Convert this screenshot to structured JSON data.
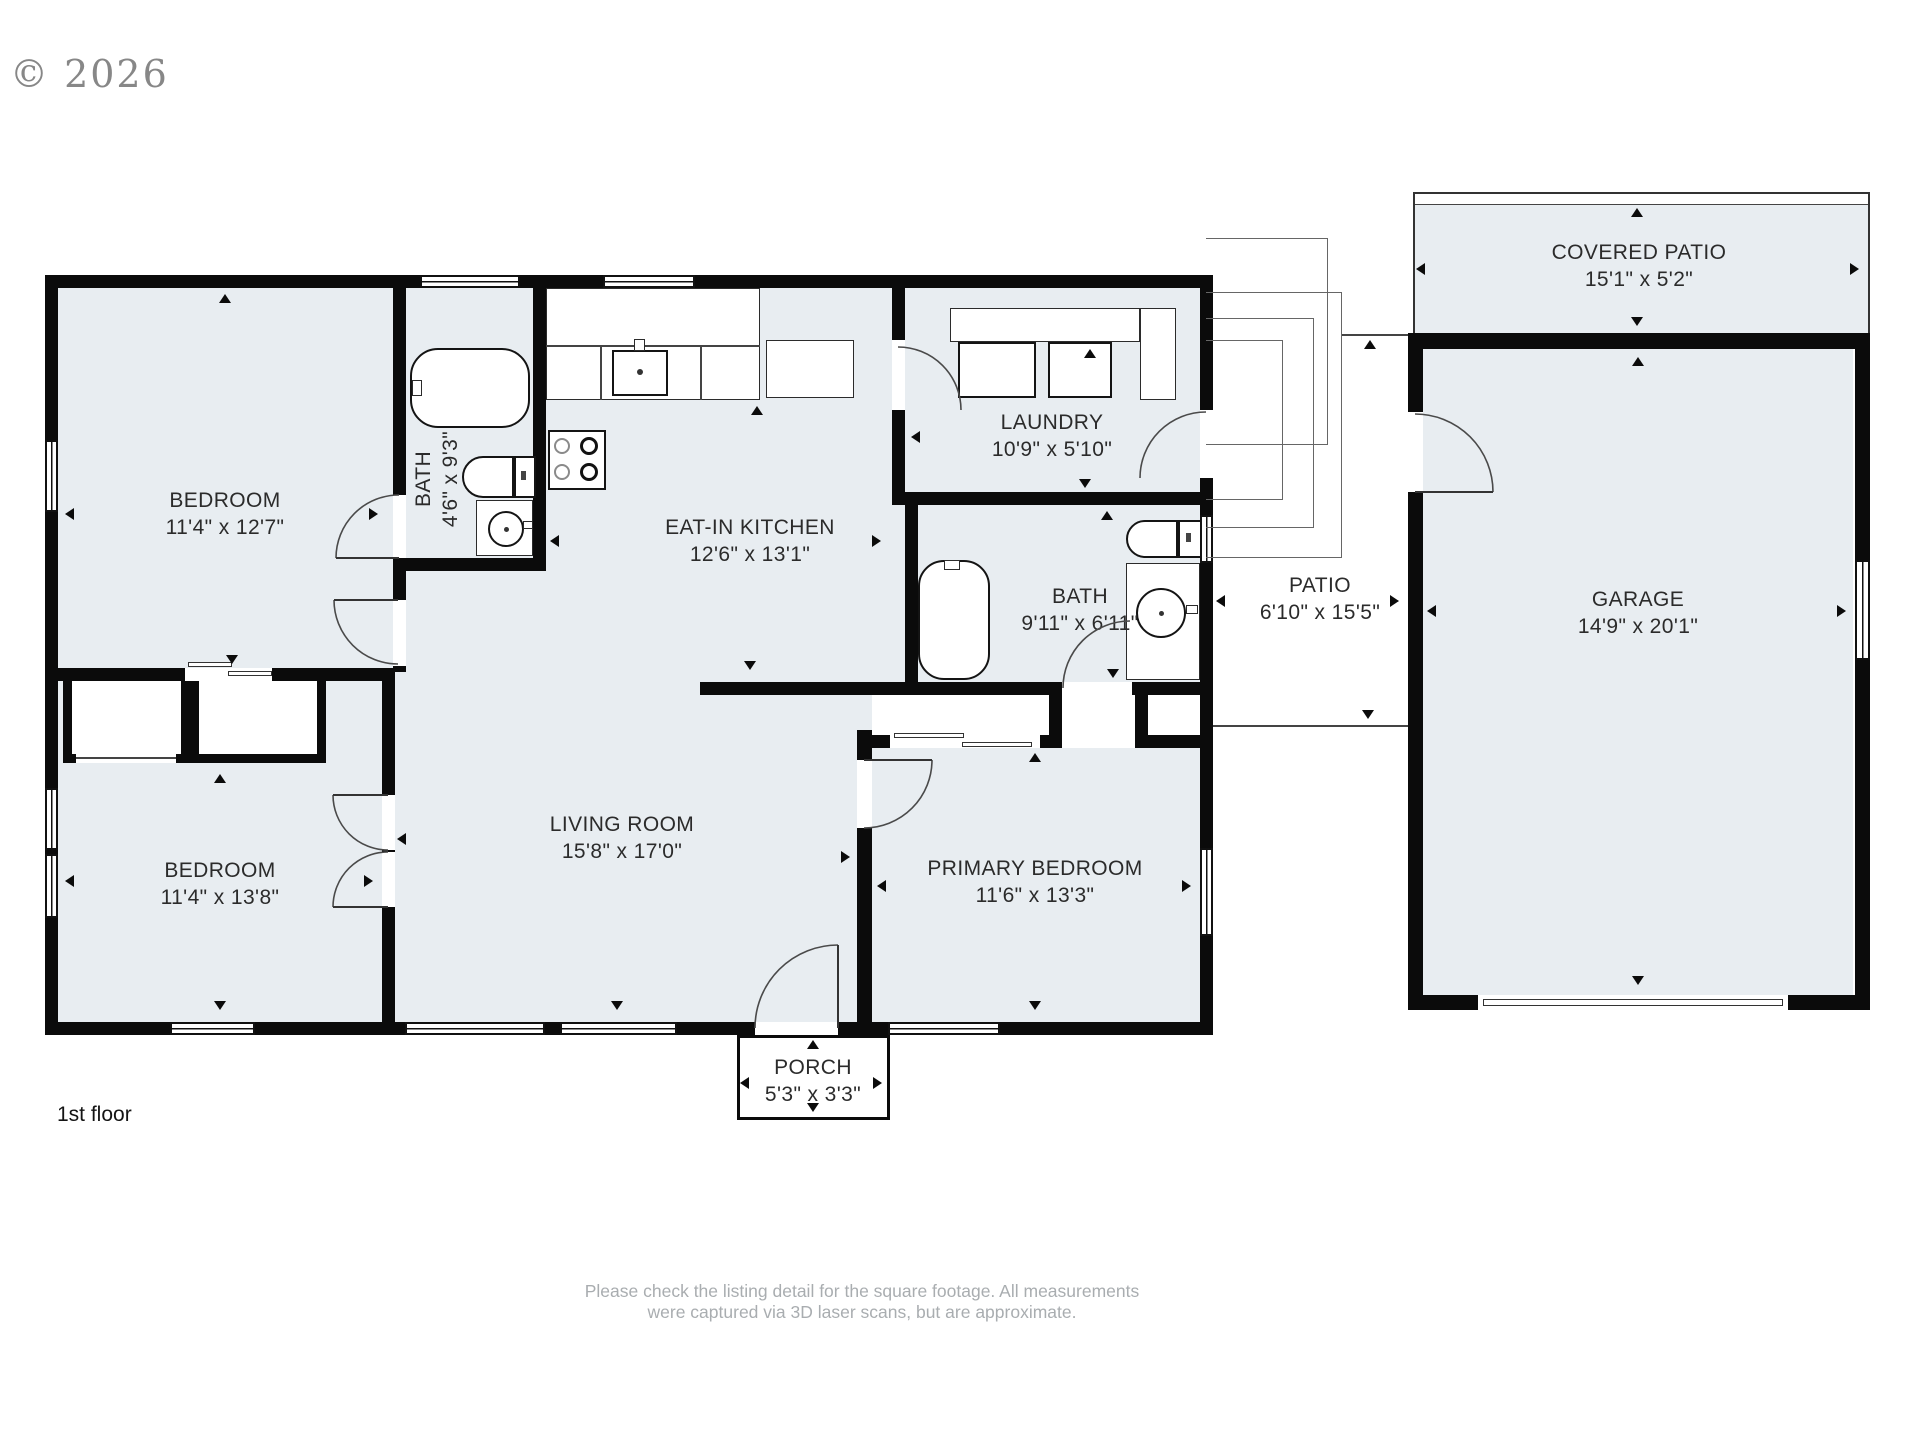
{
  "copyright": "© 2026",
  "floor_label": "1st floor",
  "disclaimer": {
    "line1": "Please check the listing detail for the square footage. All measurements",
    "line2": "were captured via 3D laser scans, but are approximate."
  },
  "rooms": {
    "bedroom1": {
      "name": "BEDROOM",
      "dims": "11'4\" x 12'7\""
    },
    "bath1": {
      "name": "BATH",
      "dims": "4'6\" x 9'3\""
    },
    "kitchen": {
      "name": "EAT-IN KITCHEN",
      "dims": "12'6\" x 13'1\""
    },
    "laundry": {
      "name": "LAUNDRY",
      "dims": "10'9\" x 5'10\""
    },
    "bath2": {
      "name": "BATH",
      "dims": "9'11\" x 6'11\""
    },
    "living": {
      "name": "LIVING ROOM",
      "dims": "15'8\" x 17'0\""
    },
    "bedroom2": {
      "name": "BEDROOM",
      "dims": "11'4\" x 13'8\""
    },
    "primary": {
      "name": "PRIMARY BEDROOM",
      "dims": "11'6\" x 13'3\""
    },
    "porch": {
      "name": "PORCH",
      "dims": "5'3\" x 3'3\""
    },
    "patio": {
      "name": "PATIO",
      "dims": "6'10\" x 15'5\""
    },
    "garage": {
      "name": "GARAGE",
      "dims": "14'9\" x 20'1\""
    },
    "covered_patio": {
      "name": "COVERED PATIO",
      "dims": "15'1\" x 5'2\""
    }
  },
  "colors": {
    "room_fill": "#e8edf1",
    "wall": "#0b0b0b",
    "swing_line": "#4a4a4a",
    "label_text": "#2b2b2b",
    "muted_text": "#a9adb0",
    "copyright_text": "#878787"
  }
}
